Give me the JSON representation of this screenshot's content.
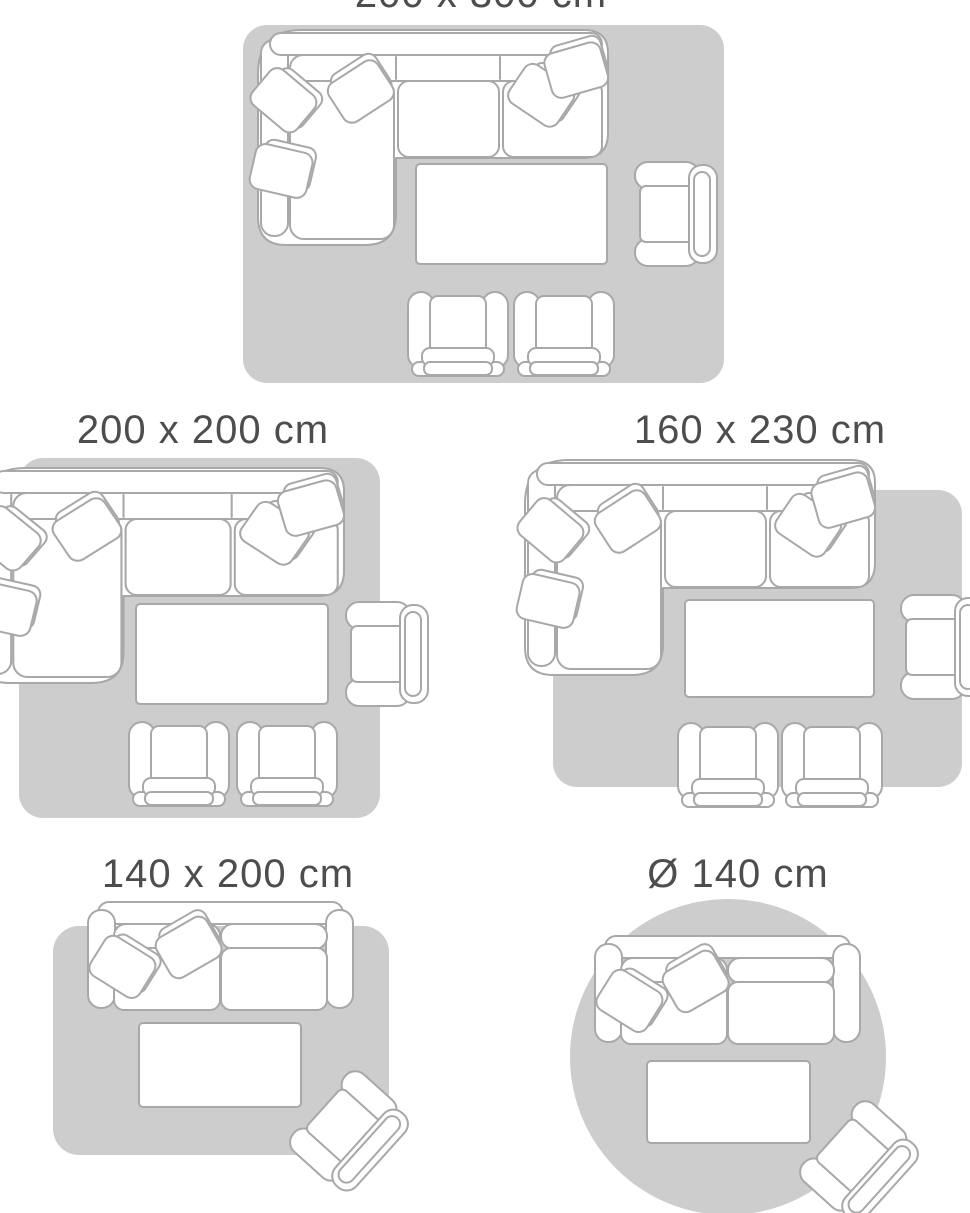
{
  "palette": {
    "page_bg": "#ffffff",
    "rug_fill": "#cdcdcd",
    "furniture_fill": "#ffffff",
    "furniture_stroke": "#a8a8a8",
    "label_color": "#4d4d4d"
  },
  "size_guide": {
    "panels": [
      {
        "label": "200 x 300 cm",
        "shape": "rectangular-rug",
        "label_visibility": "partially cropped at top edge of screenshot",
        "furniture": [
          "corner-sofa",
          "throw-pillows",
          "coffee-table",
          "armchair",
          "armchair",
          "armchair"
        ]
      },
      {
        "label": "200 x 200 cm",
        "shape": "rectangular-rug",
        "label_visibility": "fully visible",
        "furniture": [
          "corner-sofa",
          "throw-pillows",
          "coffee-table",
          "armchair",
          "armchair",
          "armchair"
        ]
      },
      {
        "label": "160 x 230 cm",
        "shape": "rectangular-rug",
        "label_visibility": "fully visible",
        "furniture": [
          "corner-sofa",
          "throw-pillows",
          "coffee-table",
          "armchair",
          "armchair",
          "armchair"
        ]
      },
      {
        "label": "140 x 200 cm",
        "shape": "rectangular-rug",
        "label_visibility": "fully visible",
        "furniture": [
          "two-seater-sofa",
          "throw-pillows",
          "coffee-table",
          "armchair-rotated"
        ]
      },
      {
        "label": "Ø 140 cm",
        "shape": "round-rug",
        "label_visibility": "fully visible",
        "furniture": [
          "two-seater-sofa",
          "throw-pillows",
          "coffee-table",
          "armchair-rotated"
        ]
      }
    ]
  }
}
